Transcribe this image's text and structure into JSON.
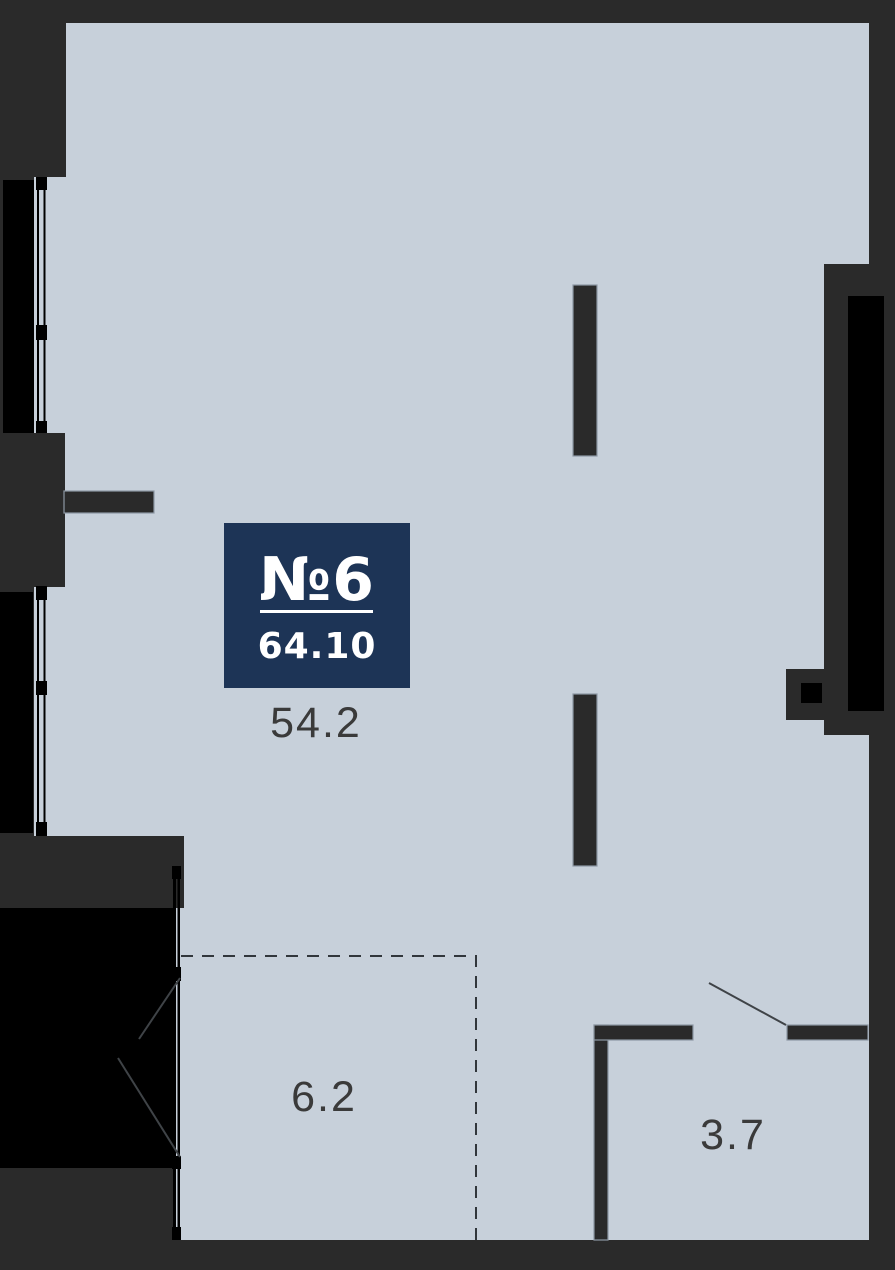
{
  "floor_plan": {
    "badge": {
      "unit_number": "№6",
      "total_area": "64.10"
    },
    "areas": {
      "living": "54.2",
      "kitchen_zone": "6.2",
      "bathroom": "3.7"
    },
    "colors": {
      "background": "#2a2a2a",
      "floor": "#c7d0da",
      "window_black": "#000000",
      "badge_navy": "#1d3456",
      "label_text": "#3a3a3a"
    }
  }
}
